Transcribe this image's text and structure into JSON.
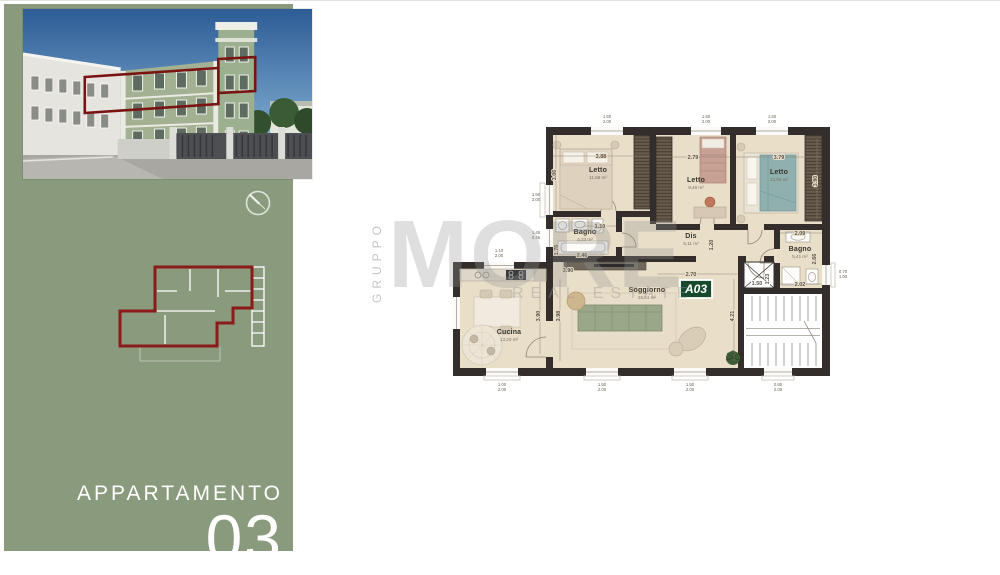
{
  "sidebar": {
    "apartment_label": "APPARTAMENTO",
    "apartment_number": "03",
    "panel_color": "#8a9a7c",
    "miniplan_outline_color": "#8b1a1a"
  },
  "photo": {
    "highlight_outline_color": "#7a1412"
  },
  "watermark": {
    "group": "GRUPPO",
    "brand": "MORE",
    "tagline": "REAL ESTATE"
  },
  "floor_plan": {
    "unit": "A03",
    "unit_badge_color": "#174a2c",
    "rooms": [
      {
        "name": "Letto",
        "area": "11,86 m²"
      },
      {
        "name": "Letto",
        "area": "9,46 m²"
      },
      {
        "name": "Letto",
        "area": "13,56 m²"
      },
      {
        "name": "Bagno",
        "area": "4,33 m²"
      },
      {
        "name": "Dis",
        "area": "5,11 m²"
      },
      {
        "name": "Bagno",
        "area": "5,41 m²"
      },
      {
        "name": "Soggiorno",
        "area": "26,51 m²"
      },
      {
        "name": "Cucina",
        "area": "13,20 m²"
      }
    ],
    "dims": [
      "3.88",
      "2.79",
      "3.79",
      "3.06",
      "3.90",
      "1.10",
      "1.76",
      "2.46",
      "1.20",
      "2.09",
      "2.66",
      "2.02",
      "2.70",
      "1.50",
      "1.23",
      "3.98",
      "3.90",
      "4.21",
      "3.90"
    ],
    "window_dims": [
      {
        "w": "1.50",
        "h": "2.00"
      },
      {
        "w": "1.50",
        "h": "2.00"
      },
      {
        "w": "1.50",
        "h": "2.00"
      },
      {
        "w": "1.50",
        "h": "2.00"
      },
      {
        "w": "1.45",
        "h": "0.45"
      },
      {
        "w": "1.10",
        "h": "2.00"
      },
      {
        "w": "0.70",
        "h": "1.00"
      },
      {
        "w": "1.00",
        "h": "2.00"
      },
      {
        "w": "1.50",
        "h": "2.00"
      },
      {
        "w": "1.50",
        "h": "2.00"
      },
      {
        "w": "0.80",
        "h": "2.00"
      }
    ]
  }
}
